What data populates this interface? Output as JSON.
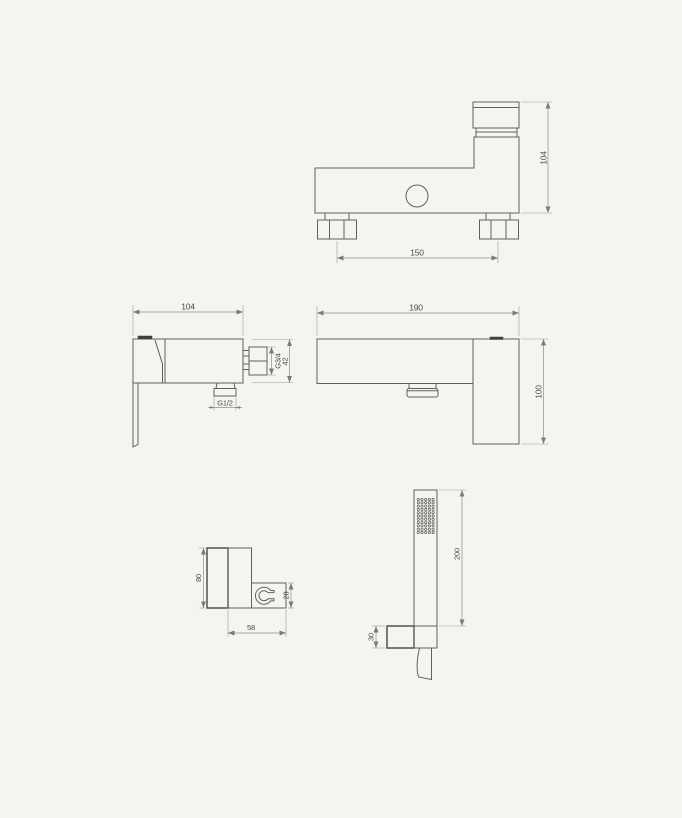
{
  "drawing": {
    "type": "technical-drawing",
    "subject": "bath-shower-mixer-faucet",
    "colors": {
      "background": "#f6f4f1",
      "outline": "#606060",
      "heavy_outline": "#474747",
      "dimension_line": "#8c8c8c",
      "text": "#4a4a4a"
    },
    "views": {
      "plan": {
        "dim_inlet_spacing": "150",
        "dim_height": "104"
      },
      "side": {
        "dim_depth": "104",
        "dim_body_height": "42",
        "label_outlet_thread": "G3/4",
        "label_inlet_thread": "G1/2"
      },
      "front": {
        "dim_width": "190",
        "dim_height": "100"
      },
      "bracket": {
        "dim_height": "80",
        "dim_clip_height": "28",
        "dim_width": "58"
      },
      "hand_shower": {
        "dim_length": "200",
        "dim_holder_height": "30"
      }
    }
  }
}
